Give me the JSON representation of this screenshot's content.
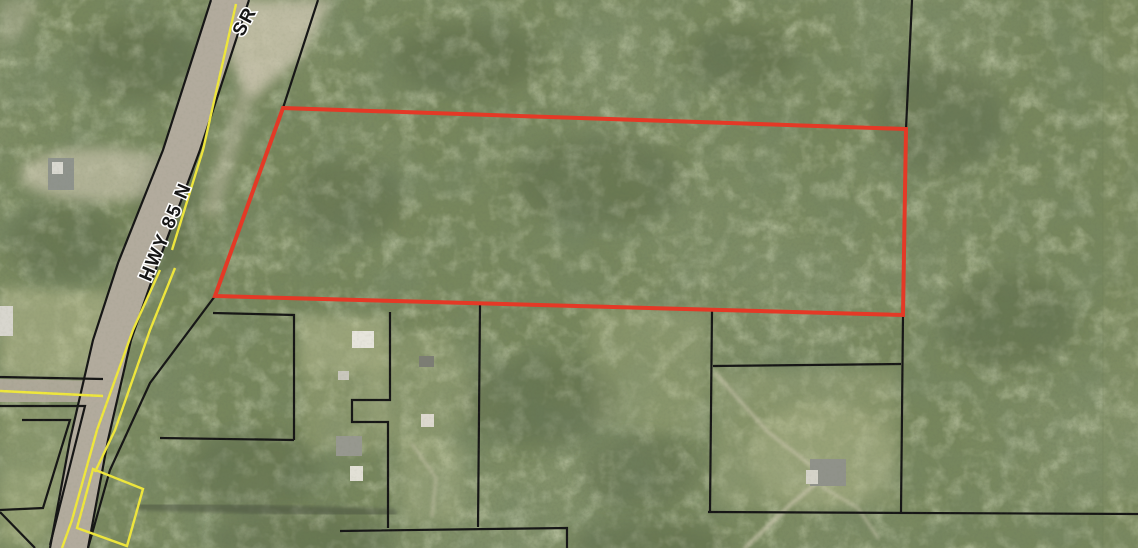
{
  "map": {
    "title": "aerial-parcel-map",
    "labels": {
      "primary_road": "HWY 85 N",
      "secondary_road": "SR"
    },
    "colors": {
      "subject_outline": "#e43926",
      "parcel_line": "#161616",
      "road_paint": "#efe73c",
      "road_fill": "#b2ab9d",
      "forest_base": "#77865c",
      "shadow": "#2e3a26",
      "label_text": "#161616",
      "label_halo": "#ffffff"
    },
    "subject_parcel": {
      "points": [
        [
          283,
          108
        ],
        [
          906,
          129
        ],
        [
          903,
          315
        ],
        [
          215,
          296
        ]
      ]
    },
    "road": {
      "left": [
        [
          211,
          0
        ],
        [
          163,
          150
        ],
        [
          118,
          263
        ],
        [
          93,
          340
        ],
        [
          70,
          440
        ],
        [
          50,
          548
        ]
      ],
      "right": [
        [
          249,
          0
        ],
        [
          200,
          150
        ],
        [
          158,
          263
        ],
        [
          131,
          340
        ],
        [
          108,
          440
        ],
        [
          88,
          548
        ]
      ]
    },
    "side_road_band": [
      [
        0,
        379
      ],
      [
        103,
        381
      ],
      [
        103,
        402
      ],
      [
        0,
        402
      ]
    ],
    "parcel_lines": [
      {
        "name": "row-line-east-of-highway",
        "pts": [
          [
            318,
            0
          ],
          [
            283,
            108
          ],
          [
            215,
            296
          ],
          [
            150,
            383
          ],
          [
            110,
            470
          ],
          [
            88,
            548
          ]
        ]
      },
      {
        "name": "north-line-x906",
        "pts": [
          [
            912,
            0
          ],
          [
            906,
            129
          ]
        ]
      },
      {
        "name": "south-line-x901",
        "pts": [
          [
            903,
            315
          ],
          [
            901,
            512
          ]
        ]
      },
      {
        "name": "line-x710",
        "pts": [
          [
            712,
            310
          ],
          [
            710,
            512
          ]
        ]
      },
      {
        "name": "line-y365",
        "pts": [
          [
            713,
            366
          ],
          [
            901,
            364
          ]
        ]
      },
      {
        "name": "line-y512-east",
        "pts": [
          [
            708,
            512
          ],
          [
            1138,
            514
          ]
        ]
      },
      {
        "name": "line-x294",
        "pts": [
          [
            213,
            313
          ],
          [
            294,
            315
          ],
          [
            294,
            440
          ]
        ]
      },
      {
        "name": "line-y440",
        "pts": [
          [
            160,
            438
          ],
          [
            294,
            440
          ]
        ]
      },
      {
        "name": "stepped-line-x390",
        "pts": [
          [
            390,
            312
          ],
          [
            390,
            400
          ],
          [
            352,
            400
          ],
          [
            352,
            422
          ],
          [
            388,
            422
          ],
          [
            388,
            528
          ]
        ]
      },
      {
        "name": "line-x480",
        "pts": [
          [
            480,
            305
          ],
          [
            478,
            527
          ]
        ]
      },
      {
        "name": "line-y530",
        "pts": [
          [
            340,
            531
          ],
          [
            567,
            528
          ],
          [
            567,
            548
          ]
        ]
      },
      {
        "name": "side-road-north-edge",
        "pts": [
          [
            0,
            377
          ],
          [
            103,
            379
          ]
        ]
      },
      {
        "name": "side-road-south-parcel",
        "pts": [
          [
            0,
            406
          ],
          [
            85,
            406
          ],
          [
            50,
            545
          ]
        ]
      },
      {
        "name": "inner-parcel-west",
        "pts": [
          [
            22,
            420
          ],
          [
            70,
            420
          ],
          [
            43,
            508
          ],
          [
            0,
            510
          ]
        ]
      },
      {
        "name": "corner-parcel-sw",
        "pts": [
          [
            0,
            512
          ],
          [
            35,
            548
          ]
        ]
      },
      {
        "name": "highway-edge-west",
        "pts": [
          [
            211,
            0
          ],
          [
            163,
            150
          ],
          [
            118,
            263
          ],
          [
            93,
            340
          ],
          [
            70,
            440
          ],
          [
            50,
            548
          ]
        ]
      },
      {
        "name": "highway-edge-east",
        "pts": [
          [
            249,
            0
          ],
          [
            200,
            150
          ],
          [
            158,
            263
          ],
          [
            131,
            340
          ],
          [
            108,
            440
          ],
          [
            88,
            548
          ]
        ]
      }
    ],
    "yellow_lines": [
      {
        "name": "centerline-north",
        "pts": [
          [
            236,
            4
          ],
          [
            203,
            150
          ],
          [
            172,
            250
          ]
        ]
      },
      {
        "name": "edge-line-west-south",
        "pts": [
          [
            160,
            270
          ],
          [
            133,
            330
          ],
          [
            97,
            430
          ],
          [
            72,
            520
          ],
          [
            62,
            548
          ]
        ]
      },
      {
        "name": "edge-line-east-south",
        "pts": [
          [
            175,
            268
          ],
          [
            150,
            330
          ],
          [
            115,
            430
          ],
          [
            95,
            472
          ]
        ]
      },
      {
        "name": "side-road-centerline",
        "pts": [
          [
            0,
            391
          ],
          [
            103,
            396
          ]
        ]
      }
    ],
    "yellow_polygon": [
      [
        93,
        469
      ],
      [
        143,
        489
      ],
      [
        127,
        546
      ],
      [
        77,
        528
      ]
    ],
    "clearings": [
      {
        "type": "polygon",
        "pts": [
          [
            233,
            0
          ],
          [
            332,
            0
          ],
          [
            300,
            58
          ],
          [
            252,
            100
          ],
          [
            228,
            58
          ]
        ],
        "fill": "#cfc8b2",
        "opacity": 0.78
      },
      {
        "type": "polygon",
        "pts": [
          [
            248,
            62
          ],
          [
            262,
            66
          ],
          [
            216,
            220
          ],
          [
            202,
            214
          ]
        ],
        "fill": "#c9c2ae",
        "opacity": 0.5
      },
      {
        "type": "ellipse",
        "cx": 100,
        "cy": 175,
        "rx": 80,
        "ry": 27,
        "fill": "#c6c2aa",
        "opacity": 0.7
      },
      {
        "type": "polygon",
        "pts": [
          [
            0,
            288
          ],
          [
            112,
            292
          ],
          [
            100,
            377
          ],
          [
            0,
            377
          ]
        ],
        "fill": "#b7bb90",
        "opacity": 0.55
      },
      {
        "type": "polygon",
        "pts": [
          [
            0,
            407
          ],
          [
            83,
            407
          ],
          [
            52,
            540
          ],
          [
            0,
            540
          ]
        ],
        "fill": "#aab383",
        "opacity": 0.3
      },
      {
        "type": "polygon",
        "pts": [
          [
            298,
            316
          ],
          [
            388,
            318
          ],
          [
            386,
            372
          ],
          [
            300,
            374
          ]
        ],
        "fill": "#bcc094",
        "opacity": 0.5
      },
      {
        "type": "polygon",
        "pts": [
          [
            300,
            374
          ],
          [
            386,
            372
          ],
          [
            386,
            452
          ],
          [
            306,
            452
          ]
        ],
        "fill": "#b0b68a",
        "opacity": 0.3
      },
      {
        "type": "polygon",
        "pts": [
          [
            588,
            306
          ],
          [
            708,
            310
          ],
          [
            706,
            436
          ],
          [
            592,
            428
          ]
        ],
        "fill": "#b4ba8e",
        "opacity": 0.26
      },
      {
        "type": "polygon",
        "pts": [
          [
            716,
            372
          ],
          [
            898,
            370
          ],
          [
            898,
            508
          ],
          [
            716,
            508
          ]
        ],
        "fill": "#b2b88c",
        "opacity": 0.28
      },
      {
        "type": "ellipse",
        "cx": 822,
        "cy": 455,
        "rx": 72,
        "ry": 52,
        "fill": "#bdc196",
        "opacity": 0.3
      },
      {
        "type": "polygon",
        "pts": [
          [
            398,
            440
          ],
          [
            466,
            444
          ],
          [
            460,
            520
          ],
          [
            402,
            522
          ]
        ],
        "fill": "#b6bc90",
        "opacity": 0.32
      },
      {
        "type": "polygon",
        "pts": [
          [
            0,
            470
          ],
          [
            58,
            472
          ],
          [
            40,
            548
          ],
          [
            0,
            548
          ]
        ],
        "fill": "#a9b284",
        "opacity": 0.35
      },
      {
        "type": "polygon",
        "pts": [
          [
            0,
            0
          ],
          [
            42,
            0
          ],
          [
            20,
            36
          ],
          [
            0,
            48
          ]
        ],
        "fill": "#c2bfa6",
        "opacity": 0.4
      },
      {
        "type": "ellipse",
        "cx": 420,
        "cy": 390,
        "rx": 55,
        "ry": 60,
        "fill": "#b3b98d",
        "opacity": 0.25
      }
    ],
    "shadows": [
      {
        "cx": 168,
        "cy": 218,
        "rx": 30,
        "ry": 62
      },
      {
        "cx": 66,
        "cy": 242,
        "rx": 58,
        "ry": 38
      },
      {
        "cx": 252,
        "cy": 472,
        "rx": 66,
        "ry": 42
      },
      {
        "cx": 540,
        "cy": 402,
        "rx": 78,
        "ry": 46
      },
      {
        "cx": 640,
        "cy": 472,
        "rx": 58,
        "ry": 38
      },
      {
        "cx": 938,
        "cy": 118,
        "rx": 66,
        "ry": 56
      },
      {
        "cx": 1008,
        "cy": 322,
        "rx": 66,
        "ry": 48
      },
      {
        "cx": 468,
        "cy": 58,
        "rx": 76,
        "ry": 36
      },
      {
        "cx": 742,
        "cy": 58,
        "rx": 56,
        "ry": 32
      },
      {
        "cx": 600,
        "cy": 182,
        "rx": 86,
        "ry": 46
      },
      {
        "cx": 348,
        "cy": 200,
        "rx": 56,
        "ry": 42
      },
      {
        "cx": 140,
        "cy": 60,
        "rx": 60,
        "ry": 40
      },
      {
        "cx": 300,
        "cy": 540,
        "rx": 90,
        "ry": 30
      },
      {
        "cx": 650,
        "cy": 545,
        "rx": 80,
        "ry": 25
      }
    ],
    "tracks": [
      {
        "pts": [
          [
            745,
            548
          ],
          [
            790,
            505
          ],
          [
            818,
            482
          ]
        ],
        "stroke": "#cdc7b0",
        "width": 4,
        "opacity": 0.65
      },
      {
        "pts": [
          [
            716,
            374
          ],
          [
            768,
            432
          ],
          [
            812,
            466
          ]
        ],
        "stroke": "#cdc7b0",
        "width": 3.5,
        "opacity": 0.6
      },
      {
        "pts": [
          [
            822,
            487
          ],
          [
            858,
            508
          ],
          [
            878,
            538
          ]
        ],
        "stroke": "#cdc7b0",
        "width": 3,
        "opacity": 0.55
      },
      {
        "pts": [
          [
            140,
            506
          ],
          [
            392,
            513
          ]
        ],
        "stroke": "#4a5140",
        "width": 9,
        "opacity": 0.5
      },
      {
        "pts": [
          [
            412,
            444
          ],
          [
            436,
            478
          ],
          [
            432,
            516
          ]
        ],
        "stroke": "#cdc7b0",
        "width": 3,
        "opacity": 0.5
      }
    ],
    "structures": [
      {
        "x": 48,
        "y": 158,
        "w": 26,
        "h": 32,
        "fill": "#8f938c"
      },
      {
        "x": 52,
        "y": 162,
        "w": 11,
        "h": 12,
        "fill": "#d9d8d0"
      },
      {
        "x": 0,
        "y": 306,
        "w": 13,
        "h": 30,
        "fill": "#d8d6ce"
      },
      {
        "x": 352,
        "y": 331,
        "w": 22,
        "h": 17,
        "fill": "#e7e5dc"
      },
      {
        "x": 338,
        "y": 371,
        "w": 11,
        "h": 9,
        "fill": "#c9c7bd"
      },
      {
        "x": 336,
        "y": 436,
        "w": 26,
        "h": 20,
        "fill": "#97988f"
      },
      {
        "x": 350,
        "y": 466,
        "w": 13,
        "h": 15,
        "fill": "#e2e0d6"
      },
      {
        "x": 419,
        "y": 356,
        "w": 15,
        "h": 11,
        "fill": "#7c7d74"
      },
      {
        "x": 421,
        "y": 414,
        "w": 13,
        "h": 13,
        "fill": "#ddd9cf"
      },
      {
        "x": 810,
        "y": 459,
        "w": 36,
        "h": 27,
        "fill": "#90928a"
      },
      {
        "x": 806,
        "y": 470,
        "w": 12,
        "h": 14,
        "fill": "#d5d3c9"
      }
    ]
  },
  "canvas": {
    "width": 1138,
    "height": 548
  }
}
